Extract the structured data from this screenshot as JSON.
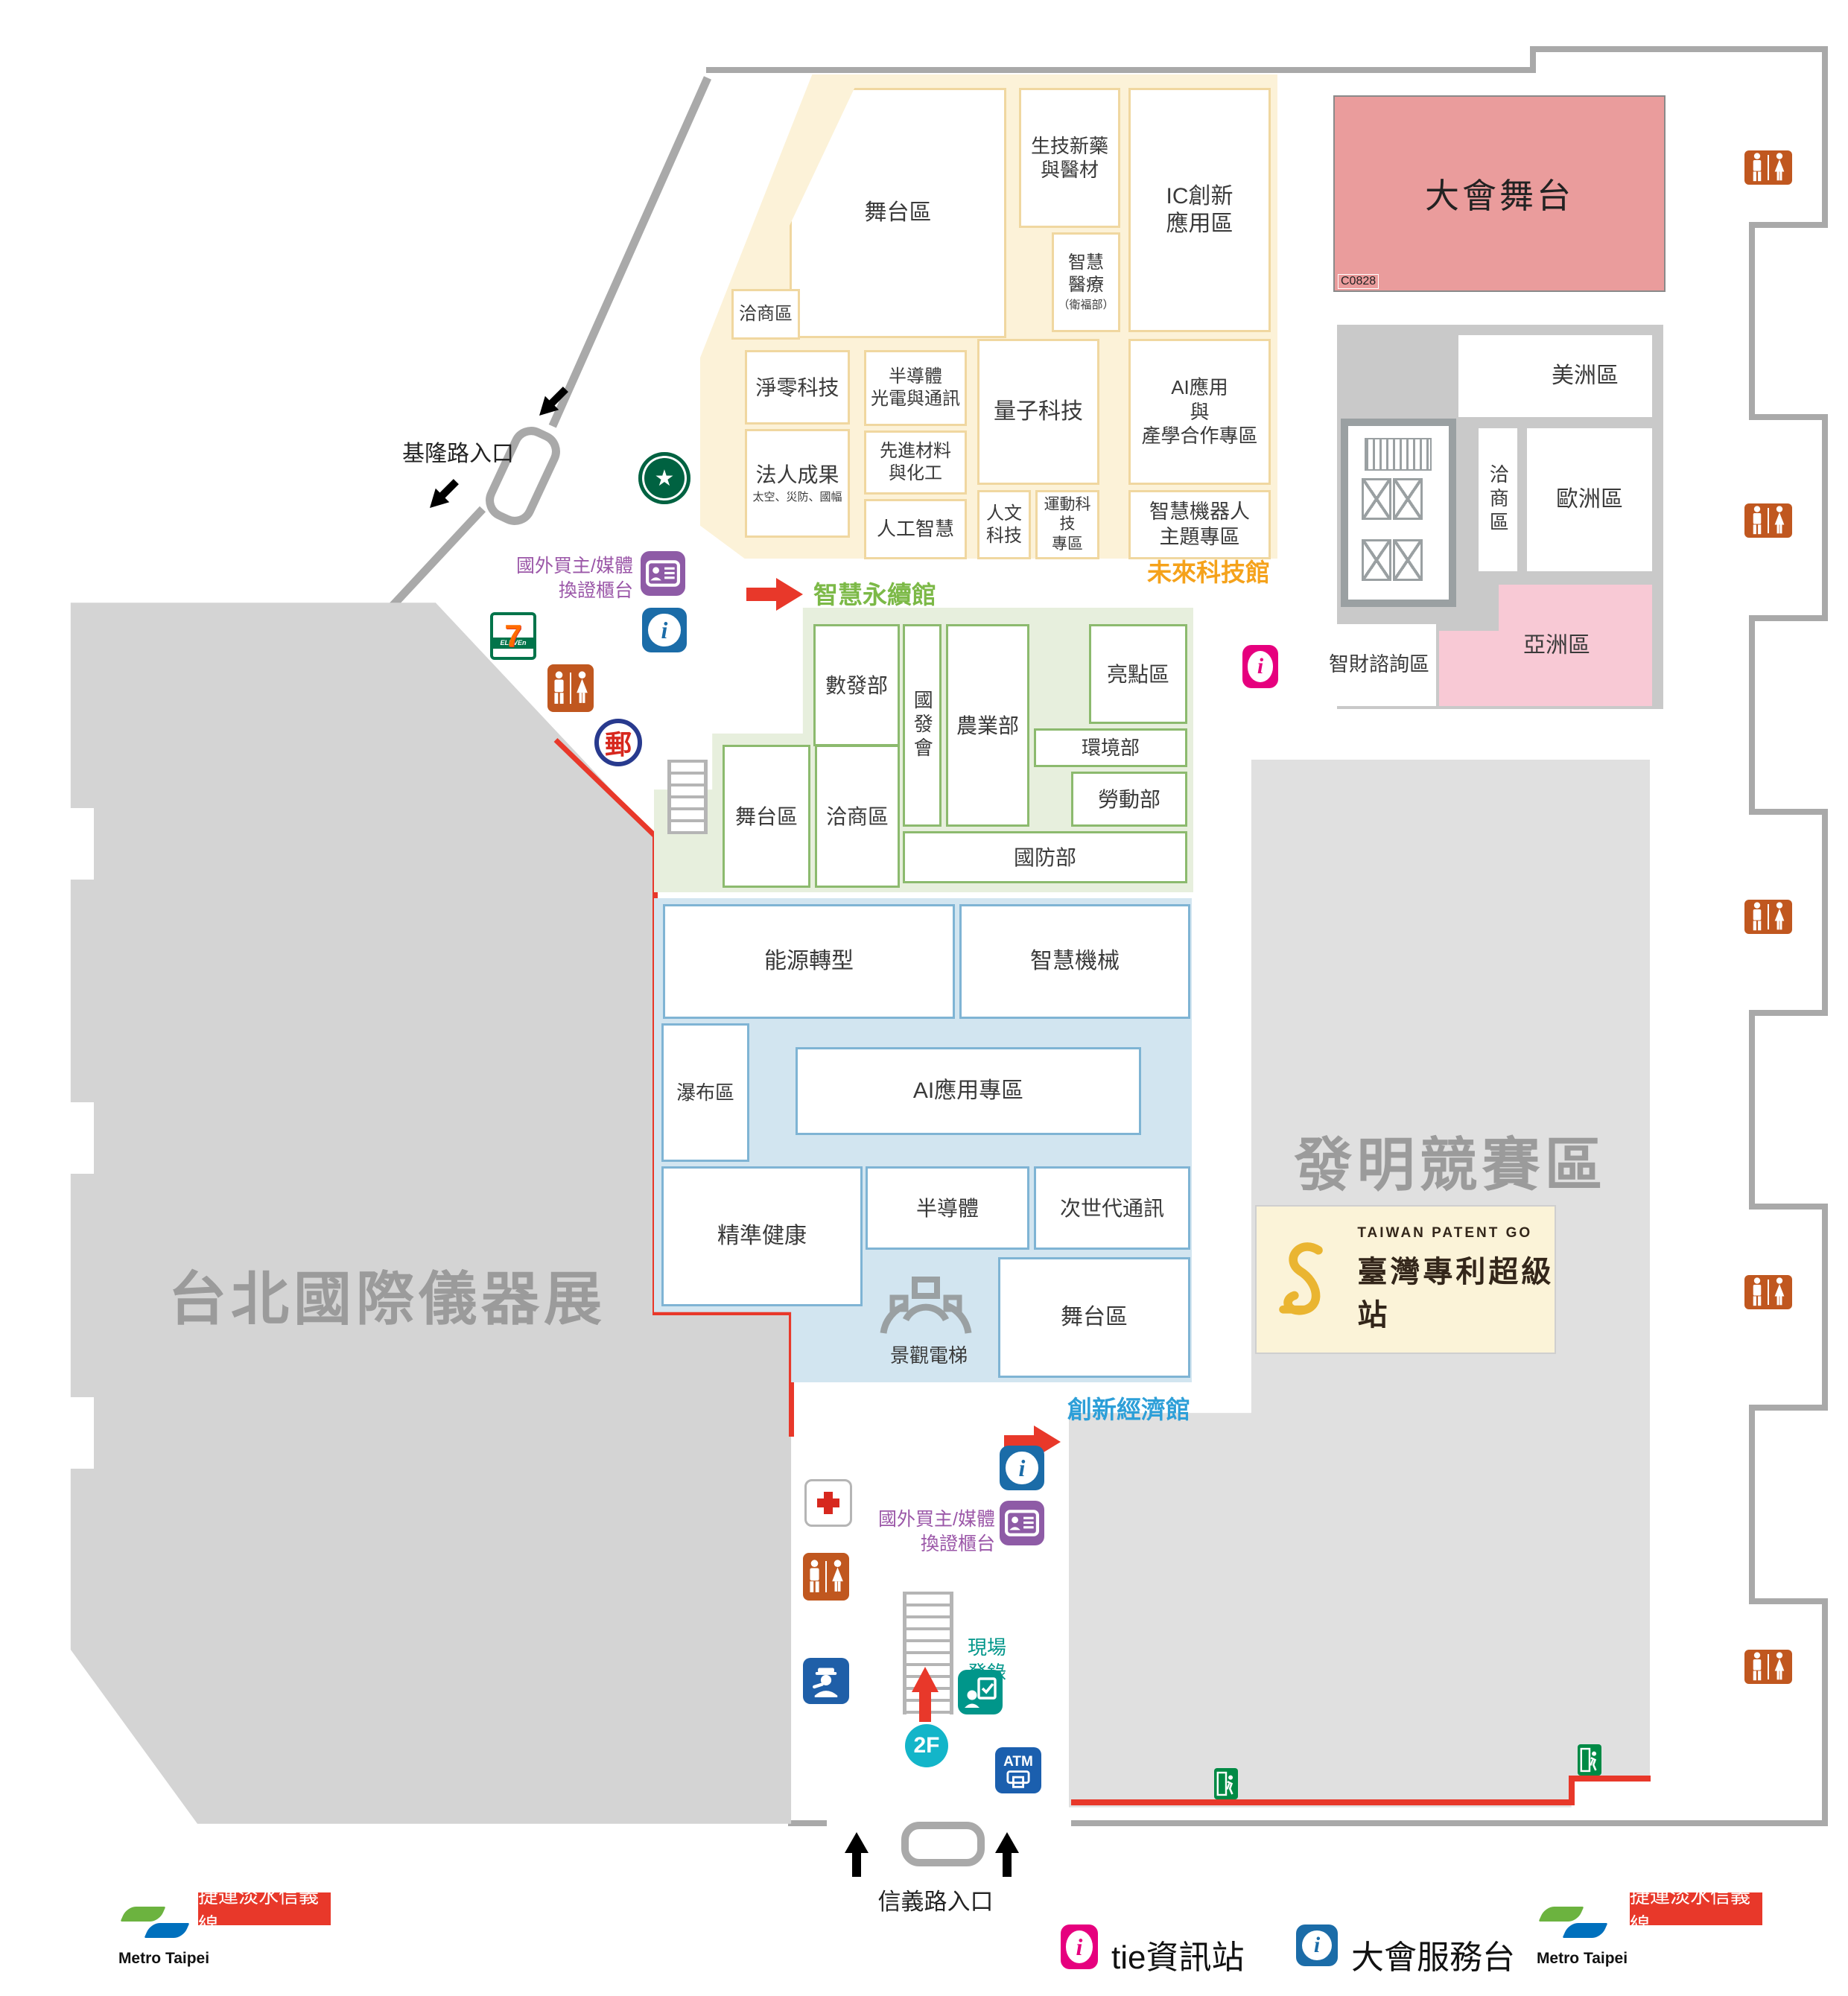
{
  "halls": {
    "future": {
      "name": "未來科技館",
      "rooms": {
        "stage": "舞台區",
        "negotiation": "洽商區",
        "biotech": "生技新藥\n與醫材",
        "smart_medical": "智慧\n醫療",
        "smart_medical_sub": "（衛福部）",
        "ic": "IC創新\n應用區",
        "netzero": "淨零科技",
        "semi_opto": "半導體\n光電與通訊",
        "quantum": "量子科技",
        "ai_academia": "AI應用\n與\n產學合作專區",
        "legal": "法人成果",
        "legal_sub": "太空、災防、國幅",
        "materials": "先進材料\n與化工",
        "ai": "人工智慧",
        "humanities": "人文\n科技",
        "sports": "運動科技\n專區",
        "robot": "智慧機器人\n主題專區"
      }
    },
    "sustain": {
      "name": "智慧永續館",
      "rooms": {
        "moda": "數發部",
        "ndc": "國發會",
        "agri": "農業部",
        "highlight": "亮點區",
        "env": "環境部",
        "labor": "勞動部",
        "defense": "國防部",
        "stage": "舞台區",
        "negotiation": "洽商區"
      }
    },
    "economy": {
      "name": "創新經濟館",
      "rooms": {
        "energy": "能源轉型",
        "machine": "智慧機械",
        "waterfall": "瀑布區",
        "ai_zone": "AI應用專區",
        "health": "精準健康",
        "semi": "半導體",
        "nextgen": "次世代通訊",
        "stage": "舞台區"
      },
      "elevator": "景觀電梯"
    }
  },
  "zones": {
    "instrument_show": "台北國際儀器展",
    "invention": "發明競賽區",
    "main_stage": "大會舞台",
    "stage_code": "C0828",
    "america": "美洲區",
    "europe": "歐洲區",
    "negotiation": "洽商區",
    "asia": "亞洲區",
    "ip_consult": "智財諮詢區"
  },
  "patent_station": {
    "en": "TAIWAN PATENT GO",
    "zh": "臺灣專利超級站"
  },
  "entrances": {
    "keelung": "基隆路入口",
    "xinyi": "信義路入口"
  },
  "services": {
    "badge_counter": "國外買主/媒體\n換證櫃台",
    "onsite_reg": "現場\n登錄",
    "floor": "2F",
    "atm": "ATM",
    "post": "郵",
    "seven": "7",
    "seven_sub": "ELEVEn"
  },
  "legend": {
    "tie_info": "tie資訊站",
    "service_desk": "大會服務台",
    "metro_brand": "Metro Taipei",
    "metro_line": "捷運淡水信義線"
  }
}
